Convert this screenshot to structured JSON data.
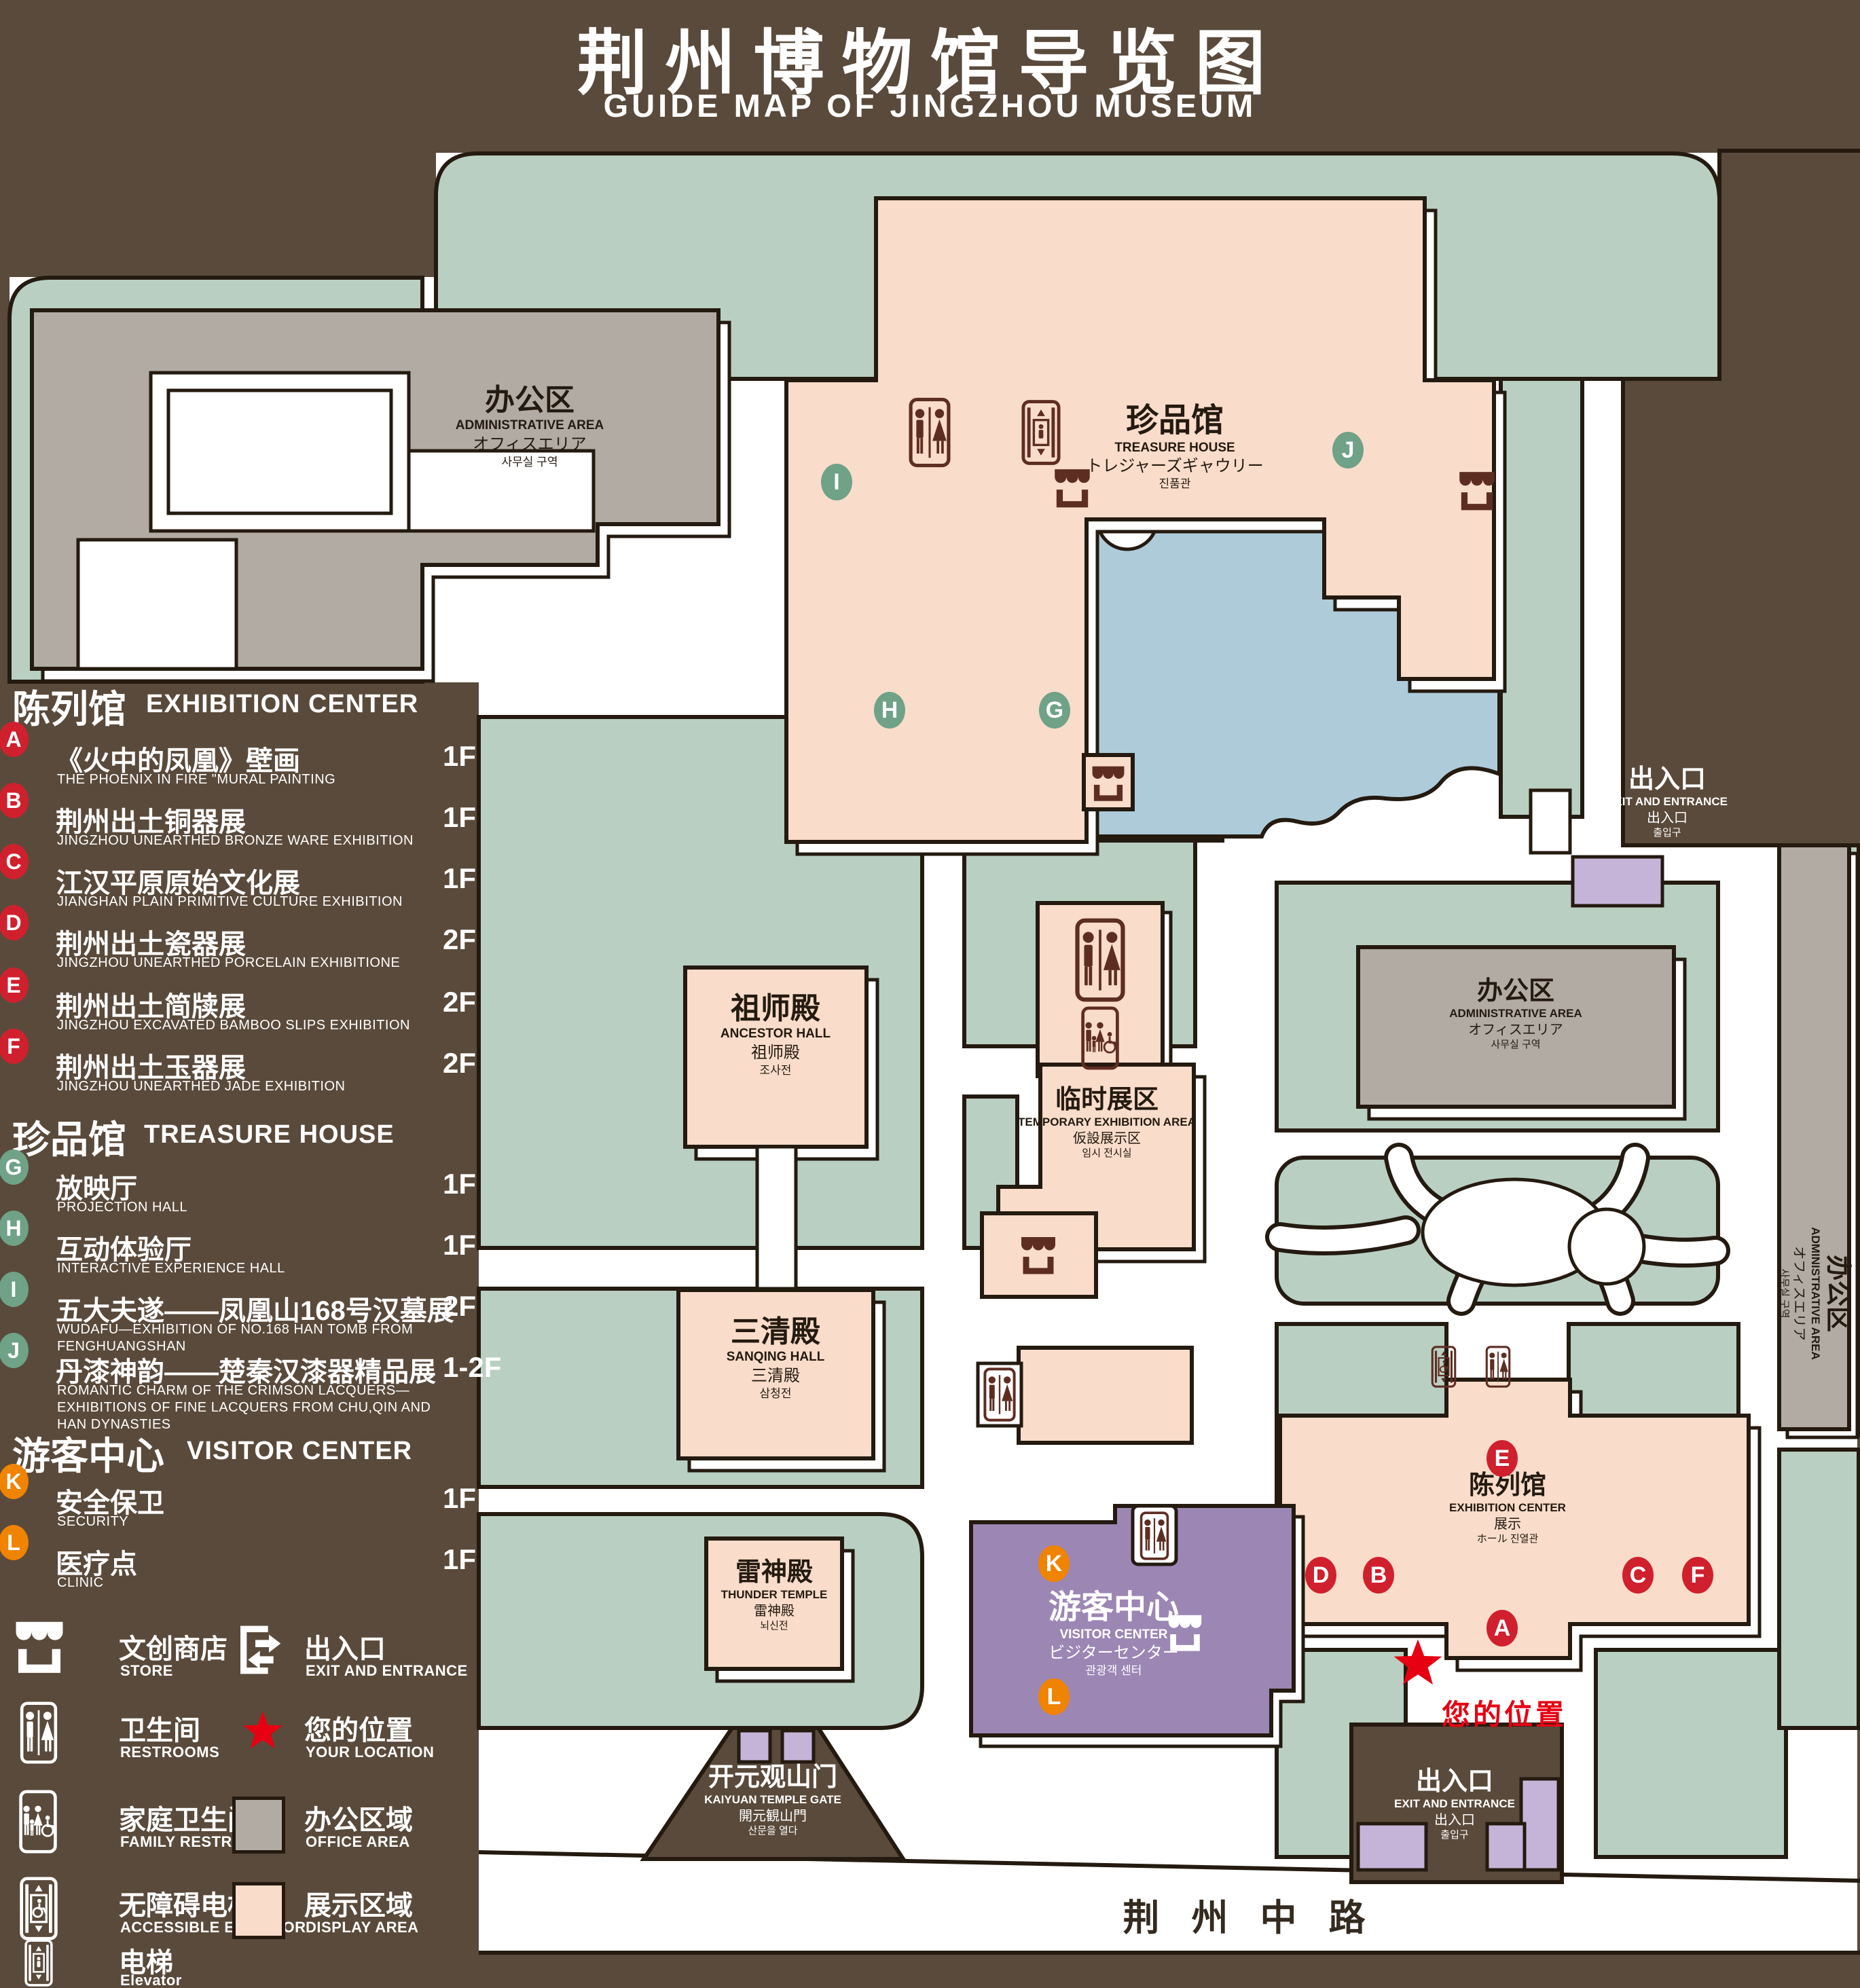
{
  "title": {
    "zh": "荆州博物馆导览图",
    "en": "GUIDE MAP OF JINGZHOU MUSEUM"
  },
  "legend": {
    "sections": [
      {
        "zh": "陈列馆",
        "en": "EXHIBITION CENTER",
        "items": [
          {
            "letter": "A",
            "zh": "《火中的凤凰》壁画",
            "en": "THE PHOENIX IN FIRE \"MURAL PAINTING",
            "floor": "1F"
          },
          {
            "letter": "B",
            "zh": "荆州出土铜器展",
            "en": "JINGZHOU UNEARTHED BRONZE WARE EXHIBITION",
            "floor": "1F"
          },
          {
            "letter": "C",
            "zh": "江汉平原原始文化展",
            "en": "JIANGHAN PLAIN PRIMITIVE CULTURE EXHIBITION",
            "floor": "1F"
          },
          {
            "letter": "D",
            "zh": "荆州出土瓷器展",
            "en": "JINGZHOU UNEARTHED PORCELAIN EXHIBITIONE",
            "floor": "2F"
          },
          {
            "letter": "E",
            "zh": "荆州出土简牍展",
            "en": "JINGZHOU EXCAVATED BAMBOO SLIPS EXHIBITION",
            "floor": "2F"
          },
          {
            "letter": "F",
            "zh": "荆州出土玉器展",
            "en": "JINGZHOU UNEARTHED JADE EXHIBITION",
            "floor": "2F"
          }
        ]
      },
      {
        "zh": "珍品馆",
        "en": "TREASURE HOUSE",
        "items": [
          {
            "letter": "G",
            "zh": "放映厅",
            "en": "PROJECTION HALL",
            "floor": "1F"
          },
          {
            "letter": "H",
            "zh": "互动体验厅",
            "en": "INTERACTIVE EXPERIENCE HALL",
            "floor": "1F"
          },
          {
            "letter": "I",
            "zh": "五大夫遂——凤凰山168号汉墓展",
            "en": "WUDAFU—EXHIBITION OF NO.168 HAN TOMB FROM FENGHUANGSHAN",
            "floor": "2F"
          },
          {
            "letter": "J",
            "zh": "丹漆神韵——楚秦汉漆器精品展",
            "en": "ROMANTIC CHARM OF THE CRIMSON LACQUERS—EXHIBITIONS OF FINE LACQUERS FROM CHU,QIN AND HAN DYNASTIES",
            "floor": "1-2F"
          }
        ]
      },
      {
        "zh": "游客中心",
        "en": "VISITOR CENTER",
        "items": [
          {
            "letter": "K",
            "zh": "安全保卫",
            "en": "SECURITY",
            "floor": "1F"
          },
          {
            "letter": "L",
            "zh": "医疗点",
            "en": "CLINIC",
            "floor": "1F"
          }
        ]
      }
    ],
    "symbols": [
      {
        "icon": "store-icon",
        "zh": "文创商店",
        "en": "STORE"
      },
      {
        "icon": "restrooms-icon",
        "zh": "卫生间",
        "en": "RESTROOMS"
      },
      {
        "icon": "family-restrooms-icon",
        "zh": "家庭卫生间",
        "en": "FAMILY RESTROOMS"
      },
      {
        "icon": "accessible-elevator-icon",
        "zh": "无障碍电梯",
        "en": "ACCESSIBLE ELEVATOR"
      },
      {
        "icon": "elevator-icon",
        "zh": "电梯",
        "en": "Elevator"
      },
      {
        "icon": "exit-entrance-icon",
        "zh": "出入口",
        "en": "EXIT AND ENTRANCE"
      },
      {
        "icon": "your-location-icon",
        "zh": "您的位置",
        "en": "YOUR LOCATION"
      },
      {
        "icon": "office-area-swatch",
        "zh": "办公区域",
        "en": "OFFICE AREA"
      },
      {
        "icon": "display-area-swatch",
        "zh": "展示区域",
        "en": "DISPLAY AREA"
      }
    ]
  },
  "map": {
    "buildings": {
      "admin": {
        "lines": [
          "办公区",
          "ADMINISTRATIVE AREA",
          "オフィスエリア",
          "사무실 구역"
        ]
      },
      "treasure": {
        "lines": [
          "珍品馆",
          "TREASURE HOUSE",
          "トレジャーズギャウリー",
          "진품관"
        ]
      },
      "ancestor": {
        "lines": [
          "祖师殿",
          "ANCESTOR HALL",
          "祖师殿",
          "조사전"
        ]
      },
      "temporary": {
        "lines": [
          "临时展区",
          "TEMPORARY EXHIBITION AREA",
          "仮設展示区",
          "임시 전시실"
        ]
      },
      "sanqing": {
        "lines": [
          "三清殿",
          "SANQING HALL",
          "三清殿",
          "삼청전"
        ]
      },
      "thunder": {
        "lines": [
          "雷神殿",
          "THUNDER TEMPLE",
          "雷神殿",
          "뇌신전"
        ]
      },
      "visitor": {
        "lines": [
          "游客中心",
          "VISITOR CENTER",
          "ビジターセンター",
          "관광객 센터"
        ]
      },
      "exhibition": {
        "lines": [
          "陈列馆",
          "EXHIBITION CENTER",
          "展示",
          "ホール 진열관"
        ]
      },
      "exit": {
        "lines": [
          "出入口",
          "EXIT AND ENTRANCE",
          "出入口",
          "출입구"
        ]
      },
      "gate": {
        "lines": [
          "开元观山门",
          "KAIYUAN TEMPLE GATE",
          "開元観山門",
          "산문을 열다"
        ]
      }
    },
    "road": "荆 州 中 路",
    "your_location": "您的位置",
    "markers": {
      "A": "A",
      "B": "B",
      "C": "C",
      "D": "D",
      "E": "E",
      "F": "F",
      "G": "G",
      "H": "H",
      "I": "I",
      "J": "J",
      "K": "K",
      "L": "L"
    }
  },
  "colors": {
    "background": "#5a4a3b",
    "lawn": "#b9cfc2",
    "display_area": "#f9dcca",
    "office_area": "#b2aba4",
    "pond": "#aecbda",
    "visitor_center": "#9c86b4",
    "gate_purple": "#c6b4d8",
    "marker_red": "#d0202e",
    "marker_green": "#6fa287",
    "marker_orange": "#f08300",
    "icon_maroon": "#5e2d22",
    "location_red": "#e60012"
  }
}
